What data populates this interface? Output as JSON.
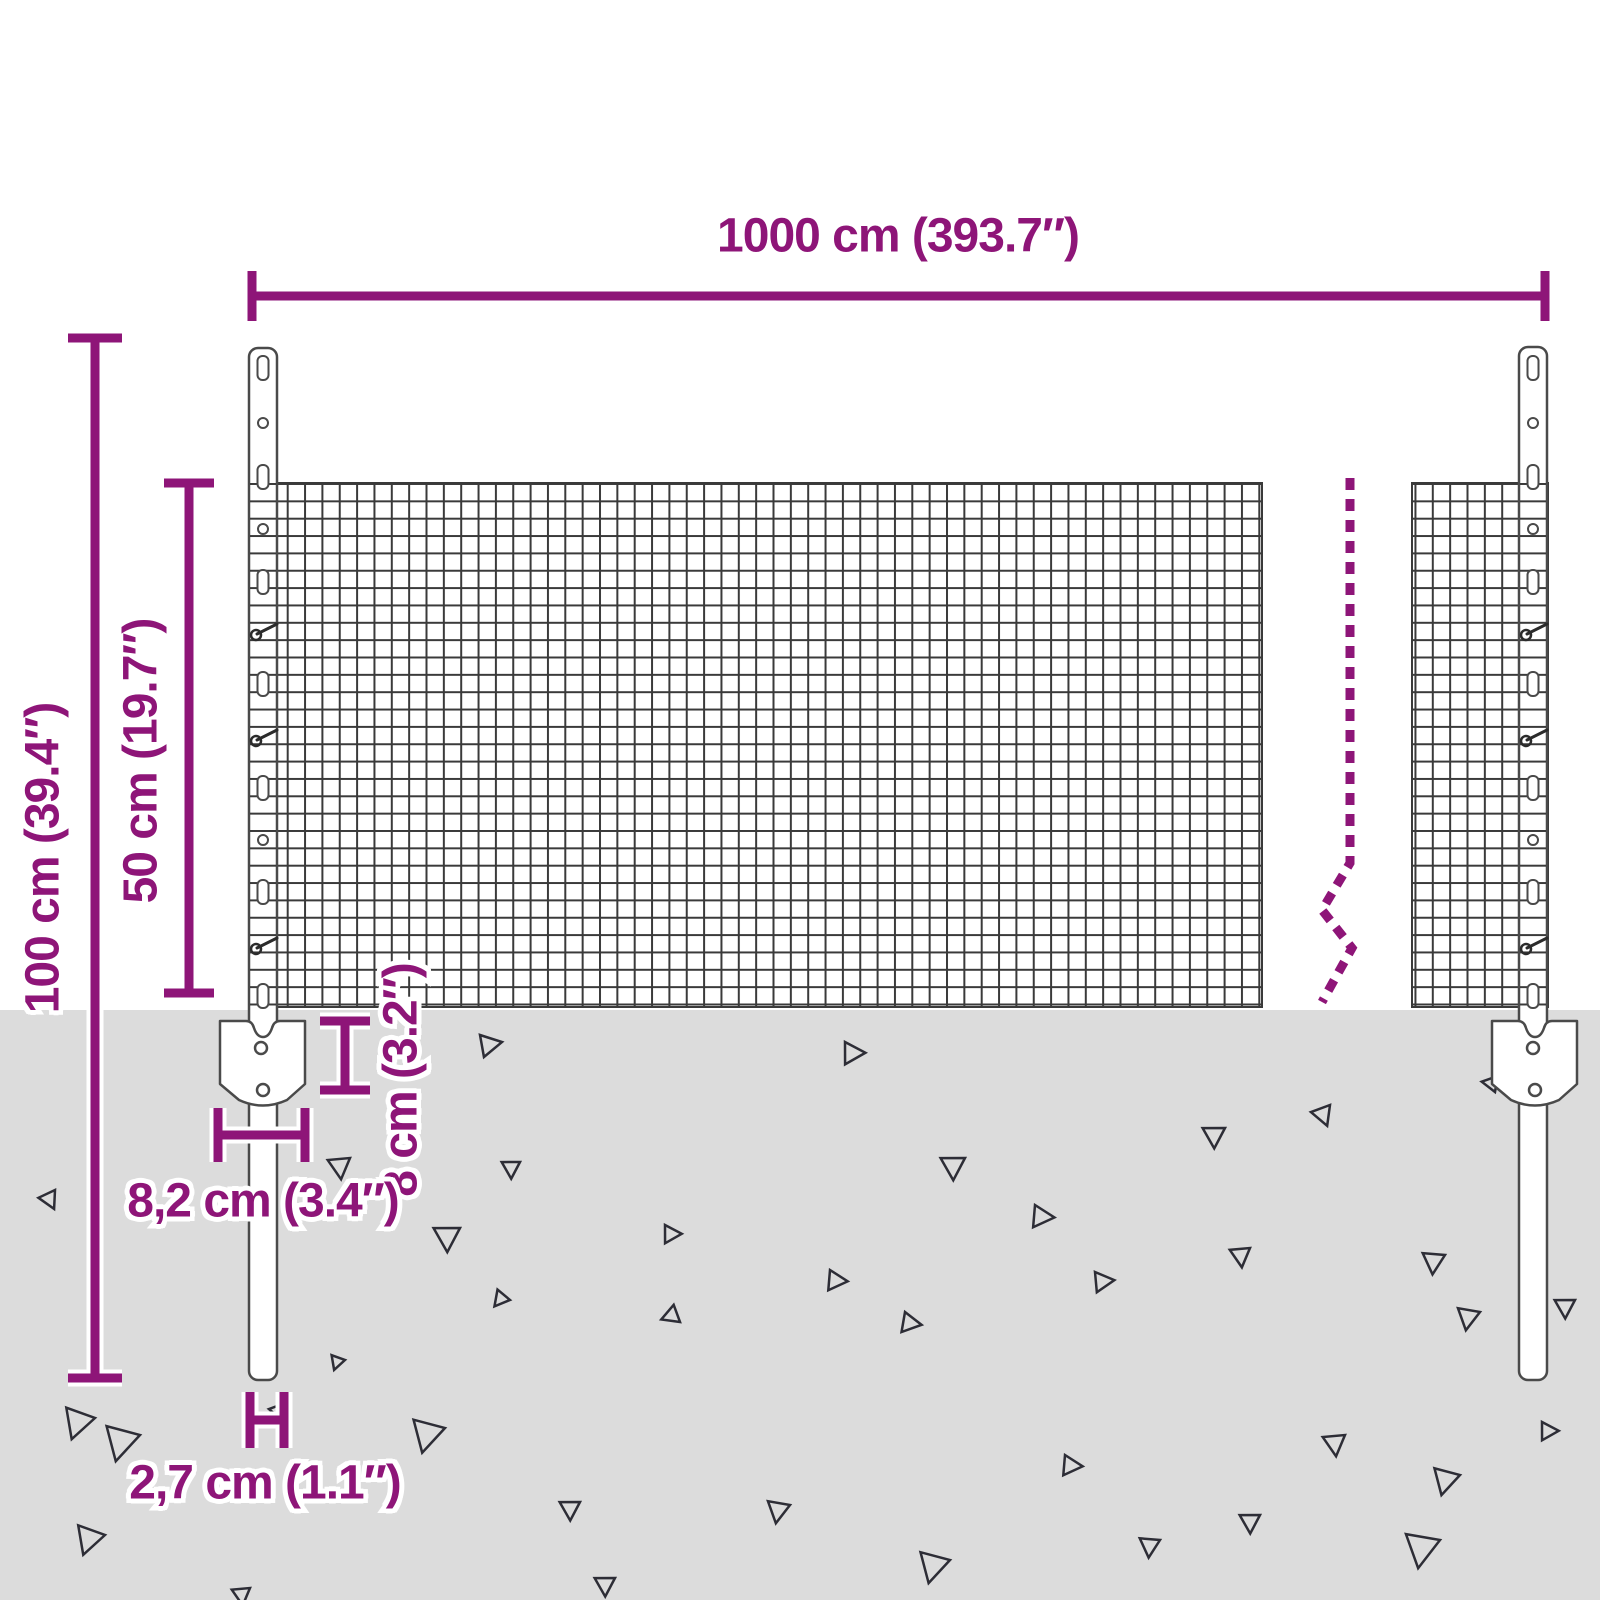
{
  "diagram": {
    "alt": "Dimension drawing of a wire mesh garden fence with two U-profile posts, ground anchors and a length break mark"
  },
  "labels": {
    "total_width": "1000 cm (393.7″)",
    "post_height": "100 cm (39.4″)",
    "mesh_height": "50 cm (19.7″)",
    "anchor_depth": "8 cm (3.2″)",
    "anchor_width": "8,2 cm (3.4″)",
    "post_width": "2,7 cm (1.1″)"
  },
  "colors": {
    "accent": "#8E1578",
    "ground": "#DCDCDC",
    "mesh_line": "#3A3A3A",
    "outline": "#4A4A4A",
    "triangle": "#2D2D36",
    "background": "#FFFFFF"
  },
  "ground": {
    "triangles": [
      {
        "x": 480,
        "y": 1035,
        "s": 22,
        "r": 0
      },
      {
        "x": 845,
        "y": 1042,
        "s": 22,
        "r": 10
      },
      {
        "x": 1330,
        "y": 1105,
        "s": 20,
        "r": 80
      },
      {
        "x": 1225,
        "y": 1128,
        "s": 22,
        "r": 100
      },
      {
        "x": 55,
        "y": 1190,
        "s": 18,
        "r": 75
      },
      {
        "x": 350,
        "y": 1158,
        "s": 22,
        "r": 95
      },
      {
        "x": 520,
        "y": 1162,
        "s": 18,
        "r": 100
      },
      {
        "x": 965,
        "y": 1158,
        "s": 24,
        "r": 100
      },
      {
        "x": 1035,
        "y": 1205,
        "s": 22,
        "r": 15
      },
      {
        "x": 1250,
        "y": 1248,
        "s": 20,
        "r": 95
      },
      {
        "x": 460,
        "y": 1228,
        "s": 26,
        "r": 100
      },
      {
        "x": 665,
        "y": 1225,
        "s": 18,
        "r": 10
      },
      {
        "x": 95,
        "y": 1418,
        "s": 30,
        "r": 120
      },
      {
        "x": 288,
        "y": 1402,
        "s": 20,
        "r": 80
      },
      {
        "x": 830,
        "y": 1270,
        "s": 20,
        "r": 15
      },
      {
        "x": 1095,
        "y": 1272,
        "s": 20,
        "r": 5
      },
      {
        "x": 1445,
        "y": 1255,
        "s": 22,
        "r": 105
      },
      {
        "x": 1575,
        "y": 1300,
        "s": 20,
        "r": 100
      },
      {
        "x": 1480,
        "y": 1312,
        "s": 22,
        "r": 110
      },
      {
        "x": 680,
        "y": 1322,
        "s": 18,
        "r": 170
      },
      {
        "x": 905,
        "y": 1312,
        "s": 20,
        "r": 20
      },
      {
        "x": 345,
        "y": 1360,
        "s": 14,
        "r": 120
      },
      {
        "x": 140,
        "y": 1435,
        "s": 34,
        "r": 115
      },
      {
        "x": 445,
        "y": 1428,
        "s": 32,
        "r": 115
      },
      {
        "x": 580,
        "y": 1502,
        "s": 20,
        "r": 100
      },
      {
        "x": 790,
        "y": 1505,
        "s": 22,
        "r": 110
      },
      {
        "x": 950,
        "y": 1560,
        "s": 30,
        "r": 115
      },
      {
        "x": 1065,
        "y": 1455,
        "s": 20,
        "r": 15
      },
      {
        "x": 1160,
        "y": 1540,
        "s": 20,
        "r": 105
      },
      {
        "x": 1345,
        "y": 1435,
        "s": 22,
        "r": 95
      },
      {
        "x": 1440,
        "y": 1540,
        "s": 34,
        "r": 110
      },
      {
        "x": 1260,
        "y": 1515,
        "s": 20,
        "r": 100
      },
      {
        "x": 615,
        "y": 1578,
        "s": 20,
        "r": 100
      },
      {
        "x": 105,
        "y": 1535,
        "s": 28,
        "r": 120
      },
      {
        "x": 250,
        "y": 1588,
        "s": 18,
        "r": 95
      },
      {
        "x": 1542,
        "y": 1422,
        "s": 18,
        "r": 10
      },
      {
        "x": 1460,
        "y": 1475,
        "s": 26,
        "r": 115
      },
      {
        "x": 510,
        "y": 1300,
        "s": 16,
        "r": 140
      },
      {
        "x": 1495,
        "y": 1092,
        "s": 16,
        "r": 200
      }
    ]
  },
  "posts": {
    "count": 2,
    "centers_x": [
      263,
      1533
    ],
    "features": {
      "slot_y": [
        368,
        477,
        582,
        684,
        788,
        892,
        996
      ],
      "hole_y": [
        423,
        529,
        840
      ],
      "hook_y": [
        630,
        736,
        944
      ]
    }
  }
}
